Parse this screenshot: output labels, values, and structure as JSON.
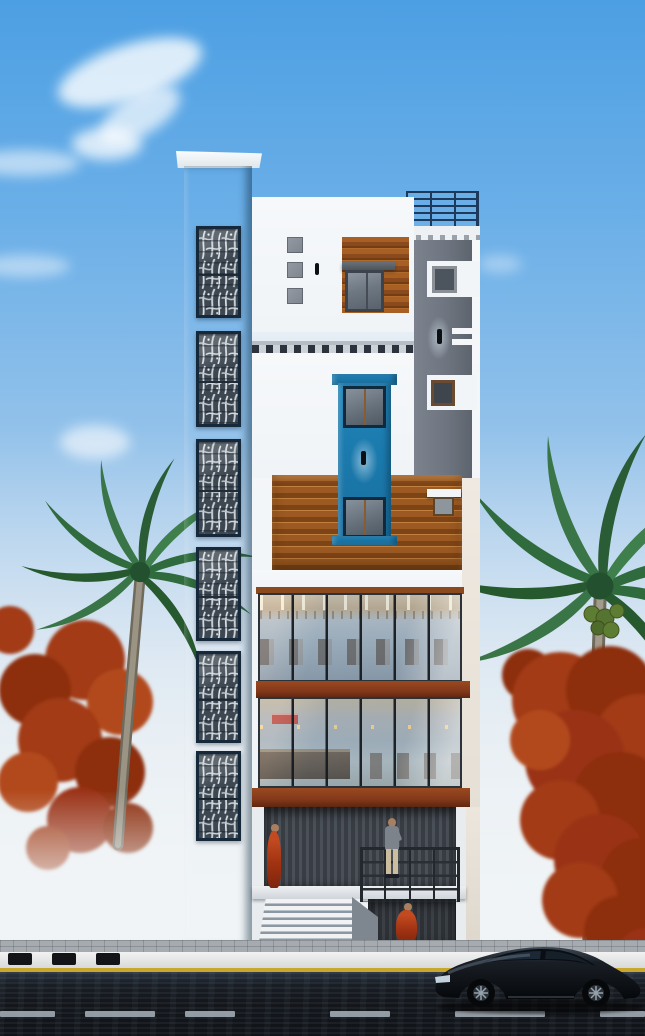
{
  "scene": {
    "type": "architectural-render",
    "subject": "Six-storey narrow commercial building front elevation with blue stair tower, perforated screen panels, wooden cladding bands, two glass showroom floors, entrance stair, street with black coupe and two flame-coloured palm trees",
    "building": {
      "stair_tower_panels": 6,
      "glass_floors": 2,
      "glass_panes_per_floor": 6,
      "roof_railing": true,
      "facade_squares": 3,
      "wall_lamps": 3,
      "entrance_steps": 7
    },
    "figures": [
      {
        "id": "woman-standing-left",
        "pose": "standing",
        "clothing_color": "#b5411e"
      },
      {
        "id": "man-standing-porch",
        "pose": "standing",
        "clothing_color": "#7d838b"
      },
      {
        "id": "woman-sitting-lower",
        "pose": "sitting",
        "clothing_color": "#c2401c"
      }
    ],
    "street": {
      "lane_dashes": 6,
      "curb_blocks": 3,
      "edge_line_color": "#c9a62c"
    },
    "vehicles": [
      {
        "id": "black-coupe",
        "color": "#0c0f13",
        "facing": "left"
      }
    ],
    "trees": [
      {
        "id": "left-palm",
        "foliage": [
          "green-palm-fronds",
          "orange-flame-foliage"
        ]
      },
      {
        "id": "right-palm",
        "foliage": [
          "green-palm-fronds",
          "orange-flame-foliage"
        ],
        "coconuts": true
      }
    ]
  },
  "colors": {
    "sky-top": "#4c9fe3",
    "sky-mid": "#93c2ea",
    "sky-low": "#d6e3ee",
    "haze": "#eef2f4",
    "tower": "#1e7aae",
    "panel-frame": "#16293b",
    "wall": "#f0f4f7",
    "graycol": "#6e7580",
    "navy": "#1d3a5c",
    "wood-l": "#a85f24",
    "beam": "#83381a",
    "yellow": "#c9a62c",
    "road": "#14171c",
    "dash": "#a9b3bc"
  }
}
